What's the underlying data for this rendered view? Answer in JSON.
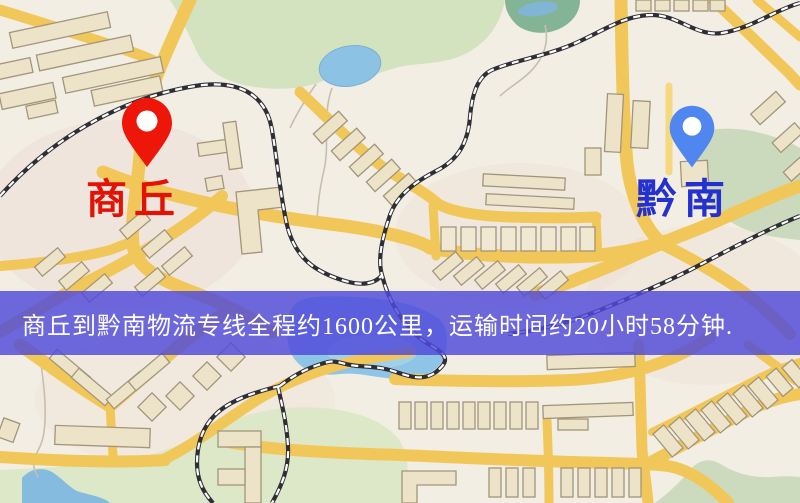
{
  "banner": {
    "text": "商丘到黔南物流专线全程约1600公里，运输时间约20小时58分钟.",
    "background_color": "rgba(79,73,218,0.82)",
    "text_color": "#ffffff",
    "distance_km": "1600",
    "duration_hours": "20",
    "duration_minutes": "58"
  },
  "markers": {
    "origin": {
      "label": "商丘",
      "pin_color": "#ee1509",
      "label_color": "#e41204"
    },
    "destination": {
      "label": "黔南",
      "pin_color": "#4f86ef",
      "label_color": "#2531cf"
    }
  },
  "map": {
    "colors": {
      "background": "#f2eee3",
      "road": "#f2c75a",
      "road_minor": "#f6d87e",
      "park": "#d3e3bf",
      "pond": "#84b496",
      "water": "#8ec4e6",
      "building_fill": "#ede3c8",
      "building_stroke": "#a2957a",
      "railway_dark": "#2f2e36",
      "railway_light": "#ffffff",
      "stream": "#c5bfae"
    }
  }
}
